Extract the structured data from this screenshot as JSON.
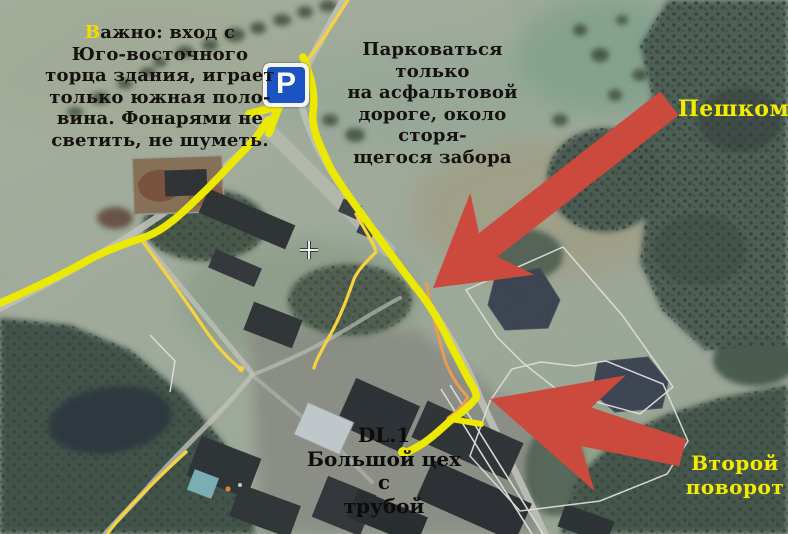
{
  "annotations": {
    "important_note": {
      "first_letter": "В",
      "first_line_rest": "ажно: вход с",
      "lines": [
        "Юго-восточного",
        "торца здания, играет",
        "только южная поло-",
        "вина. Фонарями не",
        "светить, не шуметь."
      ]
    },
    "parking_note": {
      "lines": [
        "Парковаться только",
        "на асфальтовой",
        "дороге, около сторя-",
        "щегося забора"
      ]
    },
    "walk_label": "Пешком",
    "second_turn_label": {
      "lines": [
        "Второй",
        "поворот"
      ]
    },
    "destination_label": {
      "lines": [
        "DL.1",
        "Большой цех с",
        "трубой"
      ]
    },
    "parking_sign_letter": "P"
  },
  "colors": {
    "route_yellow": "#ece900",
    "thin_road_yellow": "#f6d33e",
    "arrow_red": "#cc4a3d",
    "label_yellow": "#f4ec00",
    "note_black": "#15120e",
    "parking_sign_blue": "#1b54c0"
  }
}
